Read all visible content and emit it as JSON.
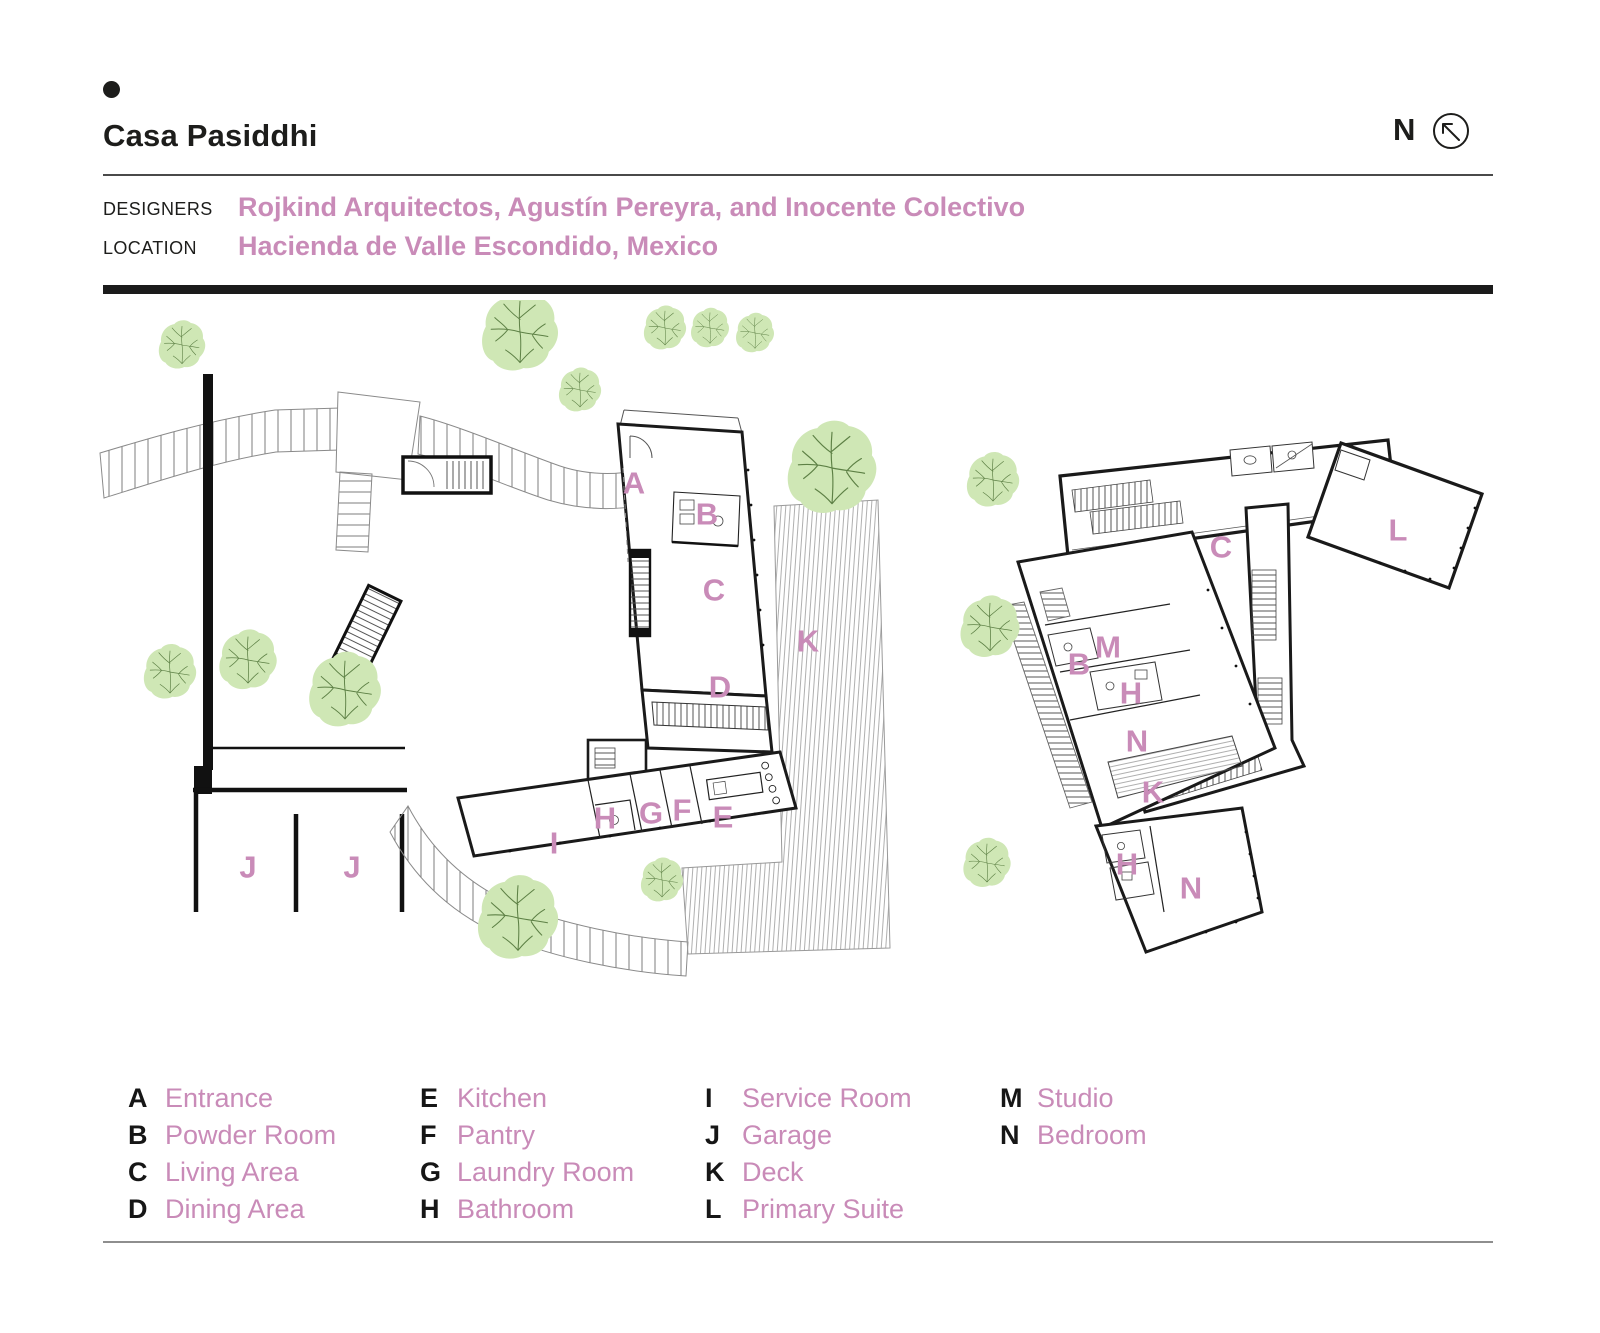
{
  "header": {
    "title": "Casa Pasiddhi"
  },
  "compass": {
    "label": "N"
  },
  "meta": {
    "designers_label": "DESIGNERS",
    "designers_value": "Rojkind Arquitectos, Agustín Pereyra, and Inocente Colectivo",
    "location_label": "LOCATION",
    "location_value": "Hacienda de Valle Escondido, Mexico"
  },
  "colors": {
    "accent": "#c98bb8",
    "ink": "#1d1d1b",
    "tree_fill": "#cfe7b5",
    "tree_branch": "#5d8045"
  },
  "legend_columns": [
    [
      {
        "letter": "A",
        "name": "Entrance"
      },
      {
        "letter": "B",
        "name": "Powder Room"
      },
      {
        "letter": "C",
        "name": "Living Area"
      },
      {
        "letter": "D",
        "name": "Dining Area"
      }
    ],
    [
      {
        "letter": "E",
        "name": "Kitchen"
      },
      {
        "letter": "F",
        "name": "Pantry"
      },
      {
        "letter": "G",
        "name": "Laundry Room"
      },
      {
        "letter": "H",
        "name": "Bathroom"
      }
    ],
    [
      {
        "letter": "I",
        "name": "Service Room"
      },
      {
        "letter": "J",
        "name": "Garage"
      },
      {
        "letter": "K",
        "name": "Deck"
      },
      {
        "letter": "L",
        "name": "Primary Suite"
      }
    ],
    [
      {
        "letter": "M",
        "name": "Studio"
      },
      {
        "letter": "N",
        "name": "Bedroom"
      }
    ]
  ],
  "legend_column_lefts": [
    128,
    420,
    705,
    1000
  ],
  "plans": {
    "ground": {
      "title": "ground-floor-site-plan",
      "labels": [
        {
          "letter": "A",
          "x": 544,
          "y": 183
        },
        {
          "letter": "B",
          "x": 617,
          "y": 214
        },
        {
          "letter": "C",
          "x": 624,
          "y": 290
        },
        {
          "letter": "D",
          "x": 630,
          "y": 387
        },
        {
          "letter": "K",
          "x": 718,
          "y": 341
        },
        {
          "letter": "I",
          "x": 464,
          "y": 543
        },
        {
          "letter": "H",
          "x": 515,
          "y": 518
        },
        {
          "letter": "G",
          "x": 561,
          "y": 513
        },
        {
          "letter": "F",
          "x": 592,
          "y": 510
        },
        {
          "letter": "E",
          "x": 633,
          "y": 517
        },
        {
          "letter": "J",
          "x": 158,
          "y": 567
        },
        {
          "letter": "J",
          "x": 262,
          "y": 567
        }
      ]
    },
    "upper": {
      "title": "upper-floor-plan",
      "labels": [
        {
          "letter": "C",
          "x": 281,
          "y": 137
        },
        {
          "letter": "L",
          "x": 458,
          "y": 120
        },
        {
          "letter": "B",
          "x": 139,
          "y": 254
        },
        {
          "letter": "M",
          "x": 168,
          "y": 237
        },
        {
          "letter": "H",
          "x": 191,
          "y": 283
        },
        {
          "letter": "N",
          "x": 197,
          "y": 331
        },
        {
          "letter": "K",
          "x": 213,
          "y": 382
        },
        {
          "letter": "H",
          "x": 187,
          "y": 454
        },
        {
          "letter": "N",
          "x": 251,
          "y": 478
        }
      ]
    }
  }
}
